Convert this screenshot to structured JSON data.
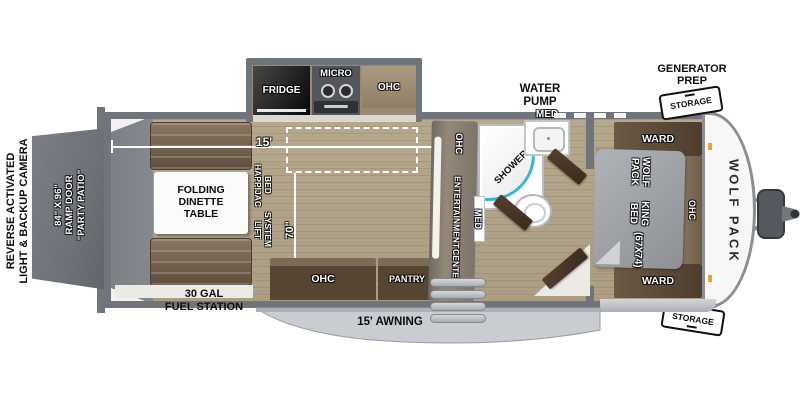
{
  "colors": {
    "wall": "#70747b",
    "floor": "#b5a88d",
    "cargo_floor": "#85888e",
    "ramp": "#6e7278",
    "cabinet_dark": "#574534",
    "cabinet_mid": "#7d6b56",
    "counter": "#dbd8d1",
    "awning": "#c9ccd0",
    "accent_teal": "#3cb4d8",
    "bed_gray": "#9fa2a7",
    "cap_white": "#f7f7f5",
    "marker_orange": "#e8a13a"
  },
  "exterior": {
    "rear_note": [
      "REVERSE ACTIVATED",
      "LIGHT & BACKUP CAMERA"
    ],
    "ramp_door": [
      "84\" X 96\"",
      "RAMP DOOR",
      "\"PARTY PATIO\""
    ],
    "fuel_station": [
      "30 GAL",
      "FUEL STATION"
    ],
    "awning": "15' AWNING",
    "water_pump": [
      "WATER",
      "PUMP"
    ],
    "generator_prep": [
      "GENERATOR",
      "PREP"
    ],
    "storage_top": "STORAGE",
    "storage_bottom": "STORAGE",
    "brand_logo": "WOLF PACK"
  },
  "kitchen": {
    "fridge": "FRIDGE",
    "micro": "MICRO",
    "ohc_top": "OHC",
    "ohc_bottom": "OHC",
    "pantry": "PANTRY"
  },
  "living": {
    "dinette": [
      "FOLDING",
      "DINETTE",
      "TABLE"
    ],
    "happijac": [
      "HAPPIJAC BED",
      "LIFT SYSTEM"
    ],
    "length_dim": "15'",
    "bed_lift_dim": "70\""
  },
  "bath": {
    "shower": "SHOWER",
    "med_top": "MED",
    "med_side": "MED",
    "ent_ohc": "OHC",
    "ent_center": [
      "ENTERTAINMENT",
      "CENTER"
    ]
  },
  "bedroom": {
    "ward_top": "WARD",
    "ward_bottom": "WARD",
    "ohc": "OHC",
    "bed": [
      "WOLF PACK",
      "KING BED",
      "(67X74)"
    ]
  }
}
